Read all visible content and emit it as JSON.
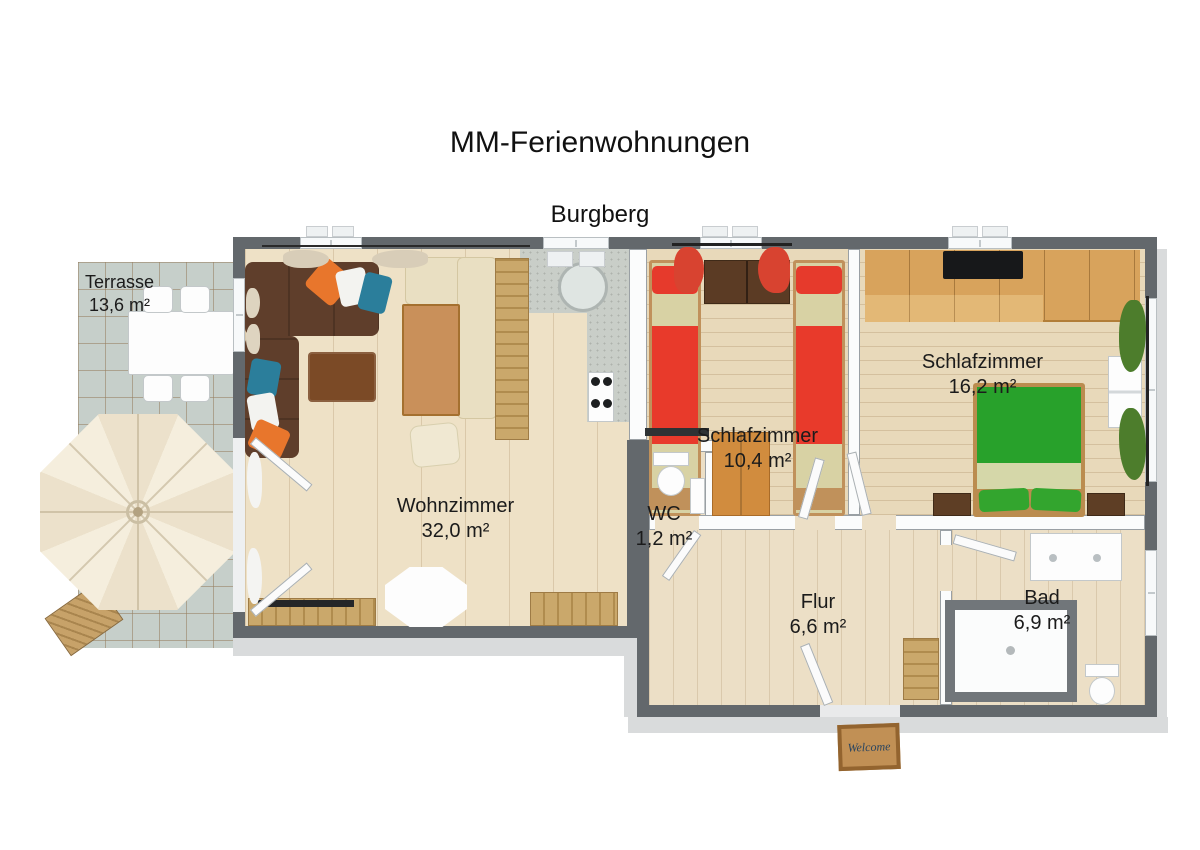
{
  "title": "MM-Ferienwohnungen",
  "subtitle": "Burgberg",
  "rooms": [
    {
      "id": "terrasse",
      "label": "Terrasse",
      "area": "13,6 m²"
    },
    {
      "id": "wohnzimmer",
      "label": "Wohnzimmer",
      "area": "32,0 m²"
    },
    {
      "id": "schlafzimmer-klein",
      "label": "Schlafzimmer",
      "area": "10,4 m²"
    },
    {
      "id": "schlafzimmer-gross",
      "label": "Schlafzimmer",
      "area": "16,2 m²"
    },
    {
      "id": "wc",
      "label": "WC",
      "area": "1,2 m²"
    },
    {
      "id": "flur",
      "label": "Flur",
      "area": "6,6 m²"
    },
    {
      "id": "bad",
      "label": "Bad",
      "area": "6,9 m²"
    }
  ],
  "doormat": {
    "text": "Welcome"
  },
  "colors": {
    "wall": "#63686c",
    "floor_wood": "#eee1c6",
    "terrace_tile": "#c6cfca",
    "sofa_brown": "#5f3e2b",
    "accent_orange": "#e8762c",
    "accent_teal": "#2b7e9b",
    "bed_red": "#e83a2b",
    "bed_green": "#28a12b",
    "curtain_red": "#d84330",
    "curtain_green": "#4d7d2c",
    "wood": "#c9905a",
    "counter": "#c9cec8",
    "doormat": "#b5854b"
  }
}
